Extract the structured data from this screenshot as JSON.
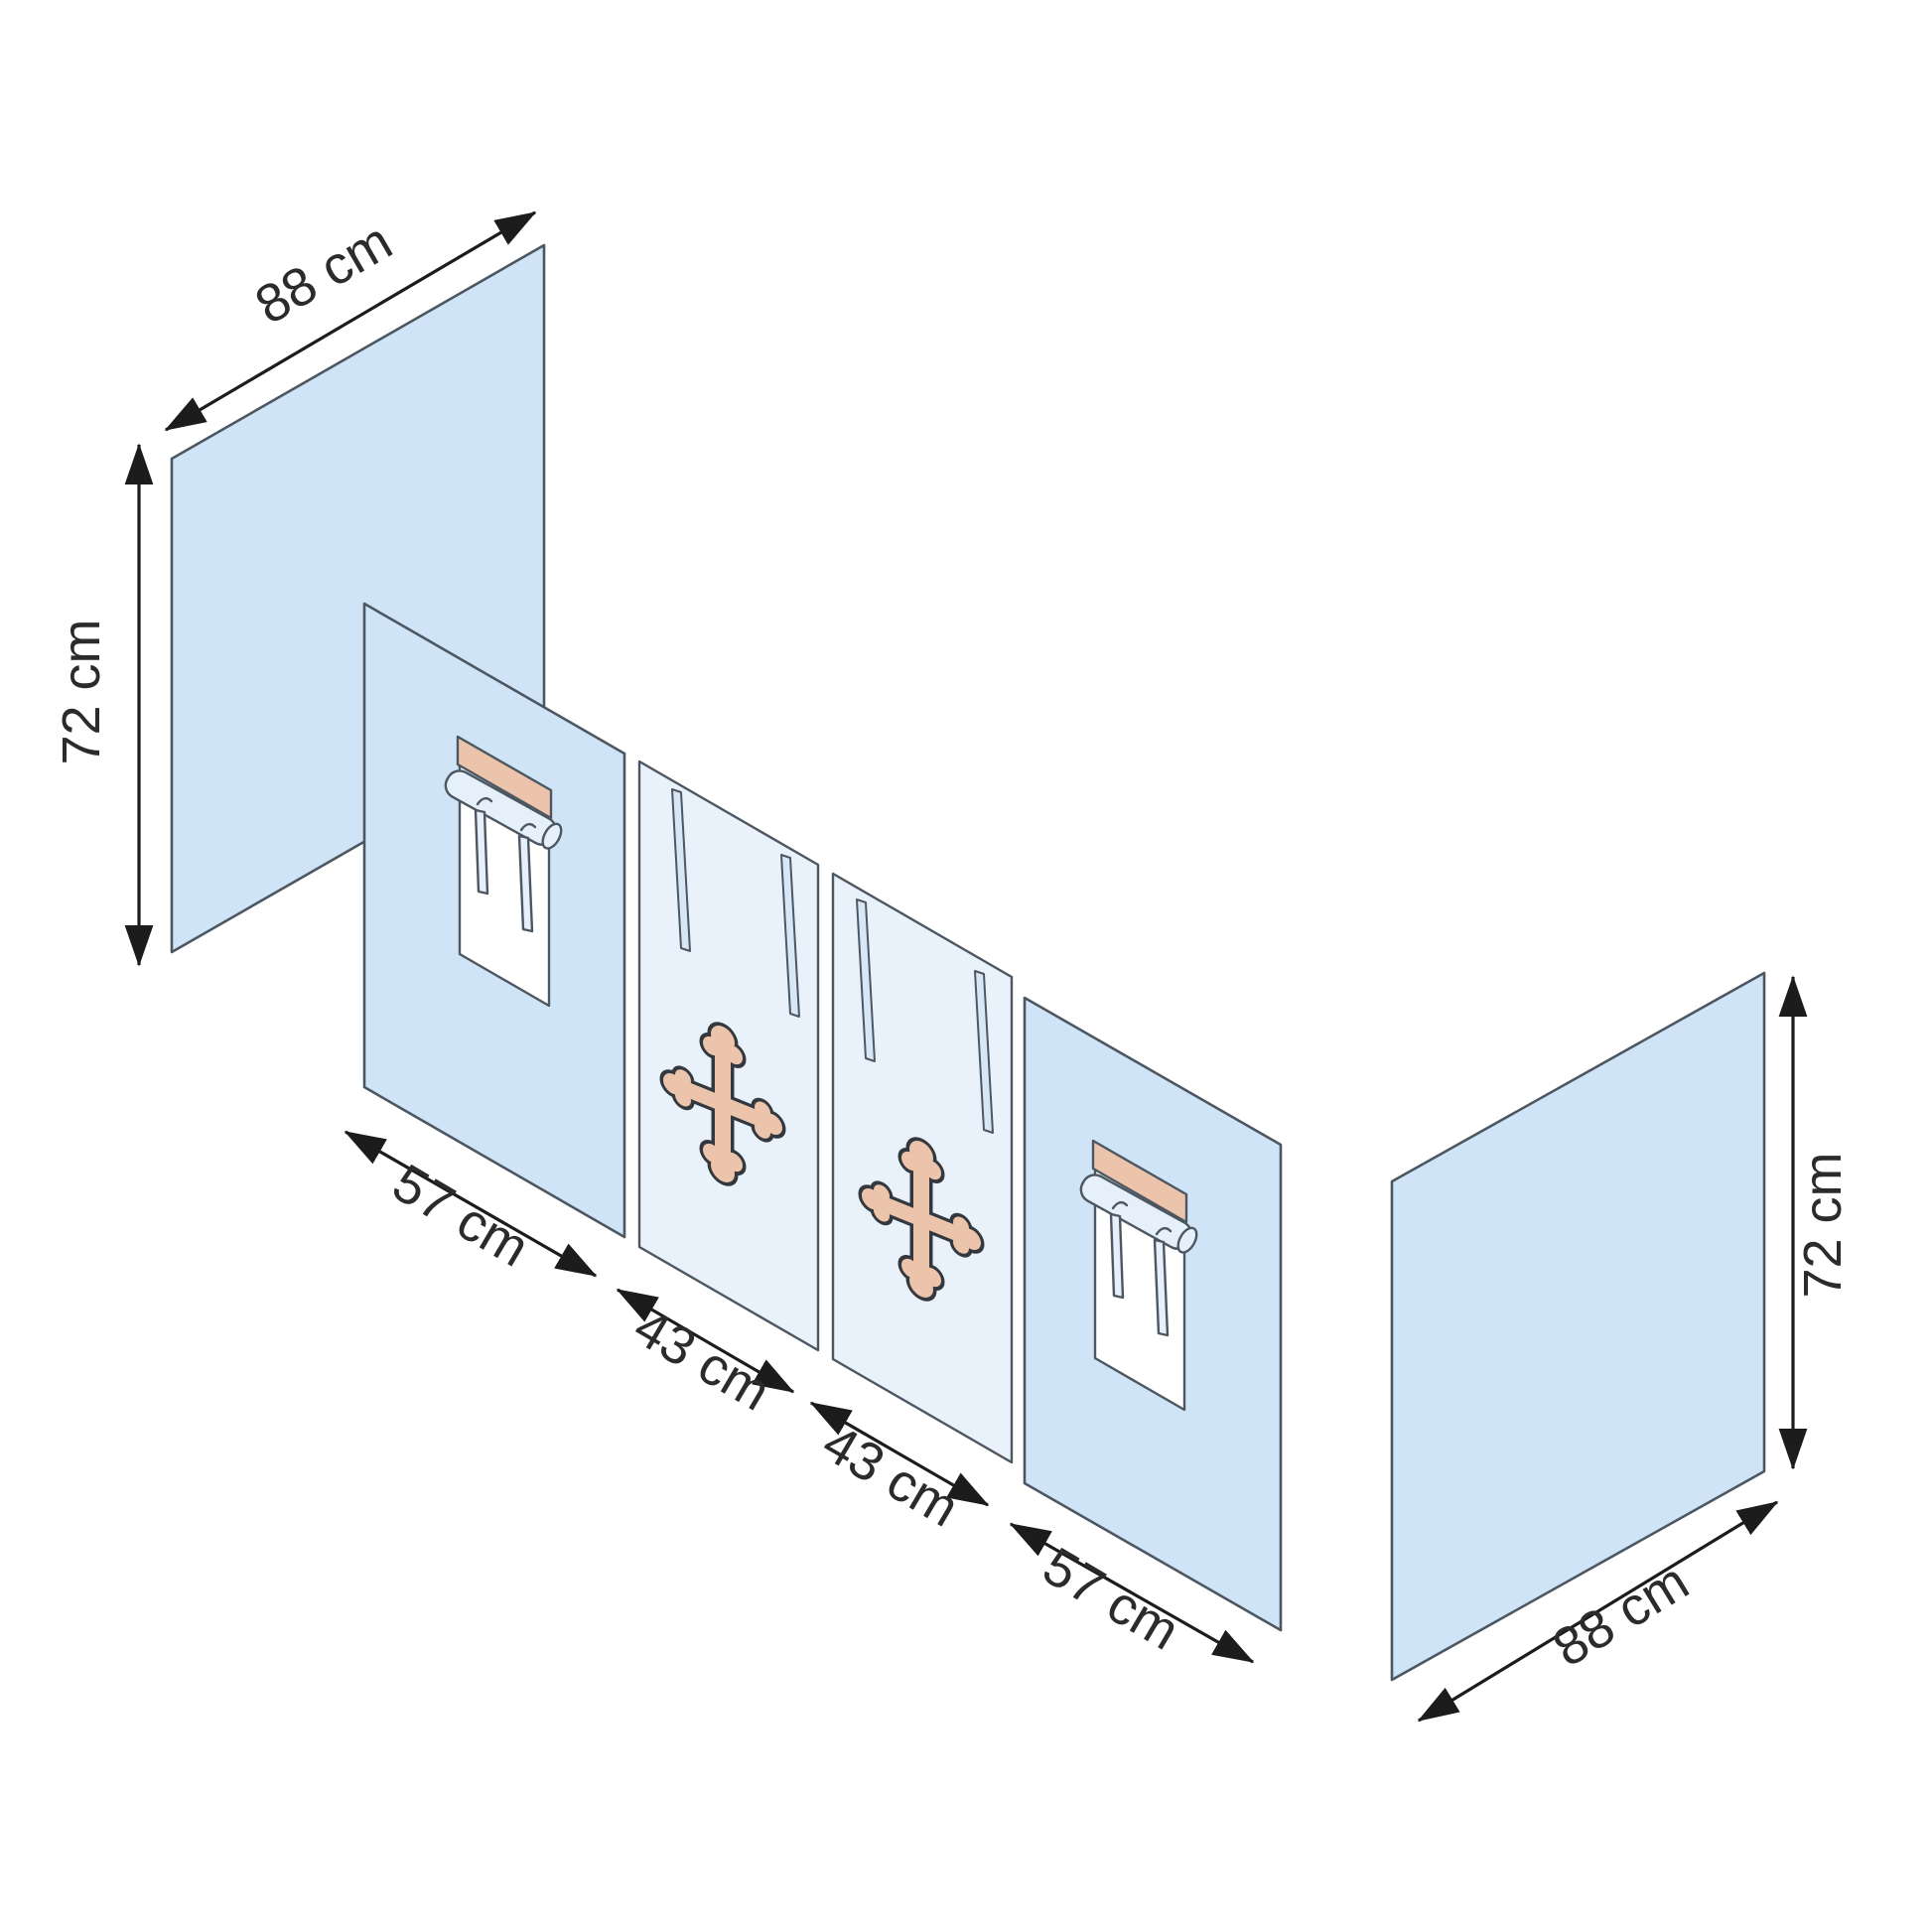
{
  "figure": {
    "type": "isometric-dimension-diagram",
    "subject": "fabric panel set (two side panels and four front curtain panels)"
  },
  "colors": {
    "background": "#ffffff",
    "white": "#ffffff",
    "panel_blue": "#cfe4f6",
    "panel_blue_light": "#e9f2fb",
    "slit_blue": "#d8e7f6",
    "curtain_blue": "#e6f0fa",
    "tan": "#ecc4ab",
    "outline": "#4d5761",
    "cross_outline": "#32383e",
    "arrow": "#1c1c1c",
    "text": "#2b2b2b"
  },
  "decorations": {
    "cross_icon": "bottony-cross",
    "curtain_icon": "rolled-curtain-with-ties",
    "slit_icon": "buttonhole-slit"
  },
  "dimensions": {
    "left_panel": {
      "width_label": "88 cm",
      "height_label": "72 cm"
    },
    "front_panels": [
      {
        "width_label": "57 cm"
      },
      {
        "width_label": "43 cm"
      },
      {
        "width_label": "43 cm"
      },
      {
        "width_label": "57 cm"
      }
    ],
    "right_panel": {
      "width_label": "88 cm",
      "height_label": "72 cm"
    }
  }
}
